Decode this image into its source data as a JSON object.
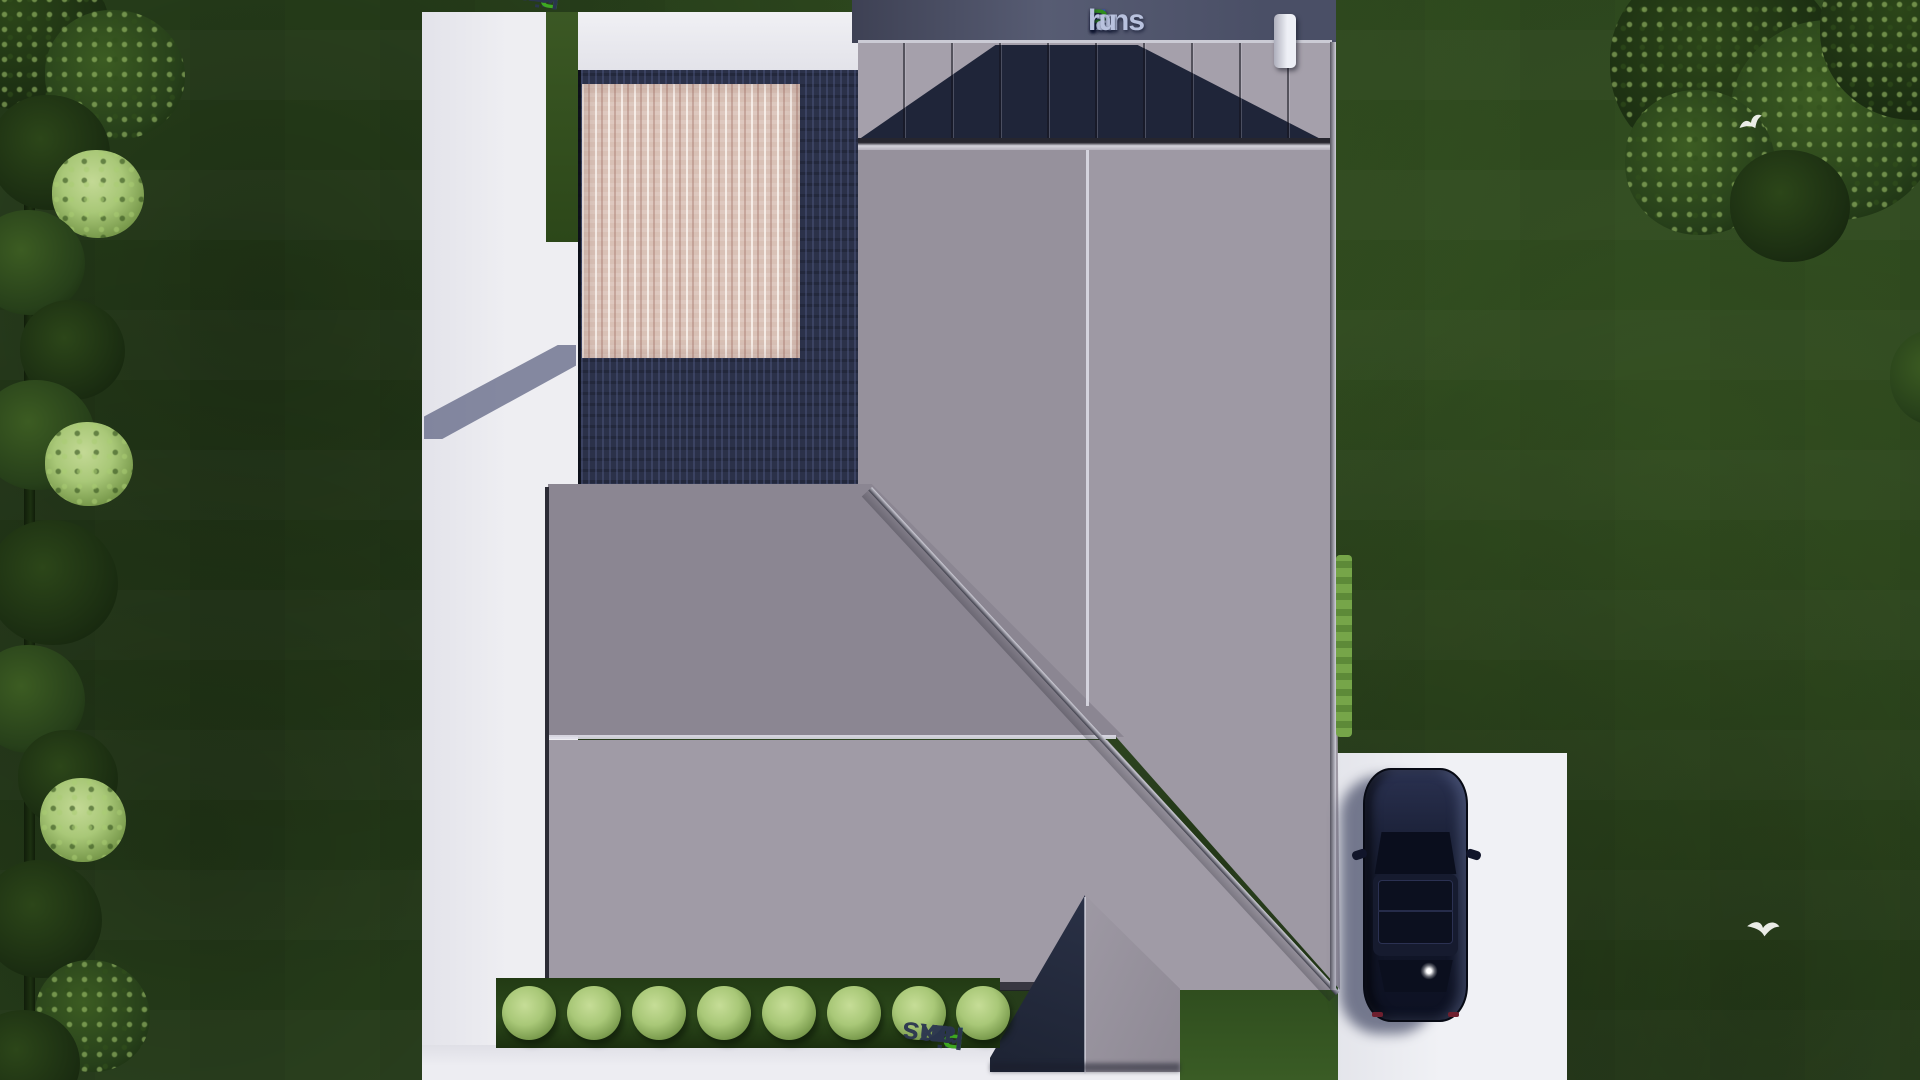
{
  "brand": {
    "name": "FixPlans.ru",
    "logo_parts": {
      "f": "F",
      "ix": "ix",
      "p": "P",
      "lans": "lans",
      "dot": ".",
      "ru": "ru"
    }
  },
  "watermarks": {
    "top_left": {
      "text": "FixPlans.ru",
      "rotation_deg": 187,
      "parts": {
        "fix": "Fix",
        "p": "P",
        "lans": "lans",
        "dot": ".",
        "ru": "ru"
      }
    },
    "bottom": {
      "text": "FixPlans.ru",
      "rotation_deg": 186,
      "parts": {
        "fix": "Fix",
        "p": "P",
        "lans": "lans",
        "dot": ".",
        "ru": "ru"
      }
    }
  },
  "colors": {
    "grass": "#2b451d",
    "tree": "#1c2f12",
    "bush": "#a9c878",
    "hedge": "#6f9c44",
    "path": "#e9e9ee",
    "roof": "#9a95a0",
    "roof-l": "#a5a0ab",
    "roof-navy": "#1f2539",
    "deck": "#2b3149",
    "wood": "#d9c1b6",
    "slate": "#4c5168",
    "car": "#141a2e",
    "logo-blue": "#2f52c8",
    "logo-green": "#2f8c1c",
    "logo-light": "#b9c2de",
    "wm": "#2b3550",
    "wm-green": "#3fae22",
    "wm-blue": "#2196f3"
  },
  "scene": {
    "view": "top-down aerial 3D render",
    "objects": [
      "hip-roof-house",
      "standing-seam-metal-roof",
      "wood-terrace",
      "dark-wood-decking",
      "concrete-paths",
      "driveway",
      "parked-suv-car",
      "boxwood-bushes",
      "hedge-row",
      "trees",
      "flying-birds",
      "chimney",
      "porch-gable"
    ]
  }
}
